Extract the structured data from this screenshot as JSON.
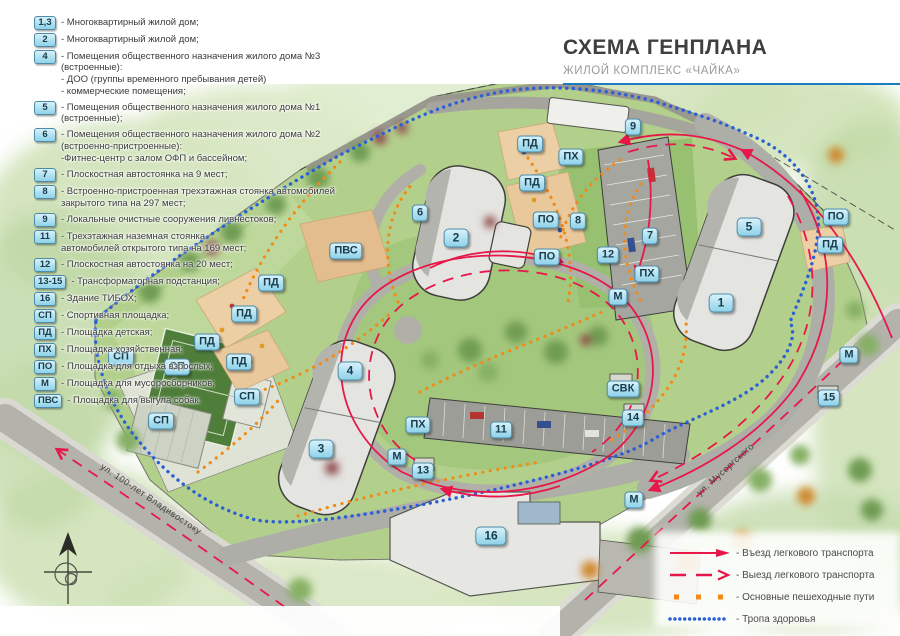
{
  "title": {
    "heading": "СХЕМА ГЕНПЛАНА",
    "subheading": "ЖИЛОЙ КОМПЛЕКС «ЧАЙКА»"
  },
  "colors": {
    "accent_rule_blue": "#1a7dc0",
    "route_red": "#e8174a",
    "pedestrian_orange": "#f28a17",
    "health_trail_blue": "#2b5fd4",
    "badge_fill": "#a8dcef",
    "badge_border": "#4d8ca8"
  },
  "legend": {
    "items": [
      {
        "badge": "1,3",
        "lines": [
          "- Многоквартирный жилой дом;"
        ]
      },
      {
        "badge": "2",
        "lines": [
          "- Многоквартирный жилой дом;"
        ]
      },
      {
        "badge": "4",
        "lines": [
          "- Помещения общественного назначения жилого дома №3 (встроенные):",
          "- ДОО (группы временного пребывания детей)",
          "- коммерческие помещения;"
        ]
      },
      {
        "badge": "5",
        "lines": [
          "- Помещения общественного назначения жилого дома №1 (встроенные);"
        ]
      },
      {
        "badge": "6",
        "lines": [
          "- Помещения общественного назначения жилого дома №2",
          "(встроенно-пристроенные):",
          "-Фитнес-центр с залом ОФП и бассейном;"
        ]
      },
      {
        "badge": "7",
        "lines": [
          "- Плоскостная автостоянка на 9 мест;"
        ]
      },
      {
        "badge": "8",
        "lines": [
          "- Встроенно-пристроенная трехэтажная стоянка автомобилей",
          "закрытого типа на 297 мест;"
        ]
      },
      {
        "badge": "9",
        "lines": [
          "- Локальные очистные сооружения ливнестоков;"
        ]
      },
      {
        "badge": "11",
        "lines": [
          "- Трехэтажная наземная стоянка",
          "автомобилей открытого типа на 169 мест;"
        ]
      },
      {
        "badge": "12",
        "lines": [
          "- Плоскостная автостоянка на 20 мест;"
        ]
      },
      {
        "badge": "13-15",
        "lines": [
          "- Трансформаторная подстанция;"
        ]
      },
      {
        "badge": "16",
        "lines": [
          "- Здание ТИБОХ;"
        ]
      },
      {
        "badge": "СП",
        "lines": [
          "- Спортивная площадка;"
        ]
      },
      {
        "badge": "ПД",
        "lines": [
          "- Площадка детская;"
        ]
      },
      {
        "badge": "ПХ",
        "lines": [
          "- Площадка хозяйственная;"
        ]
      },
      {
        "badge": "ПО",
        "lines": [
          "- Площадка для отдыха взрослых;"
        ]
      },
      {
        "badge": "М",
        "lines": [
          "- Площадка для мусоросборников;"
        ]
      },
      {
        "badge": "ПВС",
        "lines": [
          "- Площадка для выгула собак."
        ]
      }
    ]
  },
  "routes_legend": {
    "items": [
      {
        "style": "red-solid-arrow",
        "label": "- Въезд легкового транспорта"
      },
      {
        "style": "red-dashed-arrow",
        "label": "- Выезд легкового транспорта"
      },
      {
        "style": "orange-dotted",
        "label": "- Основные пешеходные пути"
      },
      {
        "style": "blue-dotted",
        "label": "- Тропа здоровья"
      }
    ]
  },
  "map": {
    "streets": [
      {
        "name": "ул. 100-лет Владивостоку"
      },
      {
        "name": "ул. Мусоргского"
      }
    ],
    "badges": [
      {
        "label": "9",
        "x": 633,
        "y": 127,
        "kind": "obj"
      },
      {
        "label": "ПД",
        "x": 530,
        "y": 144,
        "kind": "obj"
      },
      {
        "label": "ПХ",
        "x": 571,
        "y": 157,
        "kind": "obj"
      },
      {
        "label": "ПД",
        "x": 532,
        "y": 183,
        "kind": "obj"
      },
      {
        "label": "ПО",
        "x": 546,
        "y": 220,
        "kind": "obj"
      },
      {
        "label": "8",
        "x": 578,
        "y": 221,
        "kind": "obj"
      },
      {
        "label": "ПО",
        "x": 547,
        "y": 257,
        "kind": "obj"
      },
      {
        "label": "12",
        "x": 608,
        "y": 255,
        "kind": "obj"
      },
      {
        "label": "7",
        "x": 650,
        "y": 236,
        "kind": "obj"
      },
      {
        "label": "ПХ",
        "x": 647,
        "y": 274,
        "kind": "obj"
      },
      {
        "label": "М",
        "x": 618,
        "y": 297,
        "kind": "obj"
      },
      {
        "label": "ПО",
        "x": 836,
        "y": 217,
        "kind": "obj"
      },
      {
        "label": "ПД",
        "x": 830,
        "y": 245,
        "kind": "obj"
      },
      {
        "label": "6",
        "x": 420,
        "y": 213,
        "kind": "obj"
      },
      {
        "label": "2",
        "x": 456,
        "y": 238,
        "kind": "bld"
      },
      {
        "label": "ПВС",
        "x": 346,
        "y": 251,
        "kind": "obj"
      },
      {
        "label": "ПД",
        "x": 271,
        "y": 283,
        "kind": "obj"
      },
      {
        "label": "ПД",
        "x": 244,
        "y": 314,
        "kind": "obj"
      },
      {
        "label": "ПД",
        "x": 207,
        "y": 342,
        "kind": "obj"
      },
      {
        "label": "ПД",
        "x": 239,
        "y": 362,
        "kind": "obj"
      },
      {
        "label": "СП",
        "x": 121,
        "y": 357,
        "kind": "obj"
      },
      {
        "label": "СП",
        "x": 177,
        "y": 367,
        "kind": "obj"
      },
      {
        "label": "СП",
        "x": 247,
        "y": 397,
        "kind": "obj"
      },
      {
        "label": "СП",
        "x": 161,
        "y": 421,
        "kind": "obj"
      },
      {
        "label": "5",
        "x": 749,
        "y": 227,
        "kind": "bld"
      },
      {
        "label": "1",
        "x": 721,
        "y": 303,
        "kind": "bld"
      },
      {
        "label": "4",
        "x": 350,
        "y": 371,
        "kind": "bld"
      },
      {
        "label": "3",
        "x": 321,
        "y": 449,
        "kind": "bld"
      },
      {
        "label": "ПХ",
        "x": 418,
        "y": 425,
        "kind": "obj"
      },
      {
        "label": "М",
        "x": 397,
        "y": 457,
        "kind": "obj"
      },
      {
        "label": "13",
        "x": 423,
        "y": 471,
        "kind": "obj"
      },
      {
        "label": "11",
        "x": 501,
        "y": 430,
        "kind": "obj"
      },
      {
        "label": "СВК",
        "x": 623,
        "y": 389,
        "kind": "obj"
      },
      {
        "label": "14",
        "x": 633,
        "y": 418,
        "kind": "obj"
      },
      {
        "label": "15",
        "x": 829,
        "y": 398,
        "kind": "obj"
      },
      {
        "label": "М",
        "x": 849,
        "y": 355,
        "kind": "obj"
      },
      {
        "label": "М",
        "x": 634,
        "y": 500,
        "kind": "obj"
      },
      {
        "label": "16",
        "x": 491,
        "y": 536,
        "kind": "bld"
      }
    ]
  }
}
